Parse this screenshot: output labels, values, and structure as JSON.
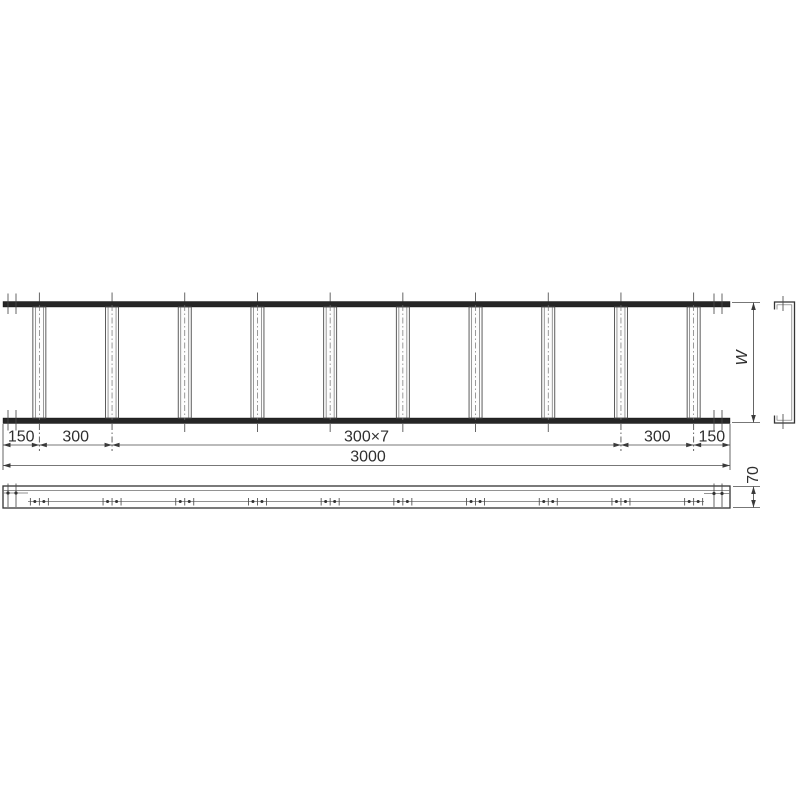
{
  "drawing": {
    "background": "#ffffff",
    "line_color": "#3a3a3a",
    "rail_color": "#262626",
    "labels": {
      "dim_total": "3000",
      "dim_width": "W",
      "dim_height": "70"
    },
    "plan_dim_segments": [
      {
        "label": "150",
        "from_mm": 0,
        "to_mm": 150
      },
      {
        "label": "300",
        "from_mm": 150,
        "to_mm": 450
      },
      {
        "label": "300×7",
        "from_mm": 450,
        "to_mm": 2550
      },
      {
        "label": "300",
        "from_mm": 2550,
        "to_mm": 2850
      },
      {
        "label": "150",
        "from_mm": 2850,
        "to_mm": 3000
      }
    ],
    "structure": {
      "total_length_mm": 3000,
      "rung_count": 10,
      "rung_pitch_mm": 300,
      "end_offset_mm": 150,
      "side_rail_height_mm": 70
    }
  }
}
